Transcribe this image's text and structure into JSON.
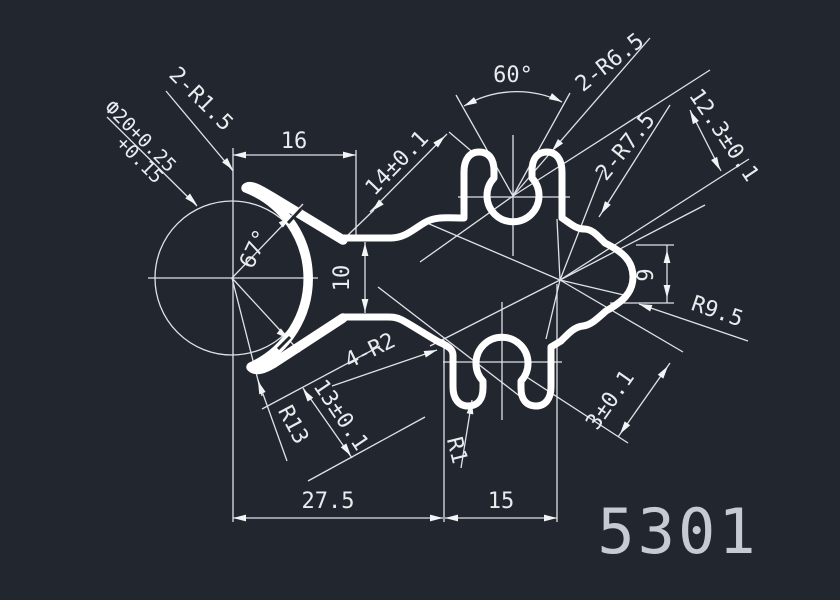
{
  "drawing": {
    "part_number": "5301",
    "labels": {
      "top_width": "16",
      "arm_diagonal": "14±0.1",
      "notch_angle": "60°",
      "top_lip_radius_pair": "2-R6.5",
      "side_radius_pair": "2-R7.5",
      "right_diagonal": "12.3±0.1",
      "bore_diameter": "Ф20+0.25",
      "bore_diameter_tolerance": "+0.15",
      "tip_radius_pair": "2-R1.5",
      "clamp_angle": "67°",
      "neck_height": "10",
      "bump_height": "9",
      "bump_radius": "R9.5",
      "clamp_radius": "R13",
      "lip_radius": "R1",
      "arm_thickness": "13±0.1",
      "lip_wall": "3±0.1",
      "corner_radius_quad": "4-R2",
      "bottom_width_left": "27.5",
      "bottom_width_right": "15"
    },
    "colors": {
      "background": "#22262e",
      "profile_line": "#ffffff",
      "dimension_line": "#dfe3e7",
      "dimension_text": "#e9ecef",
      "part_number_text": "#c6cbd2"
    }
  }
}
